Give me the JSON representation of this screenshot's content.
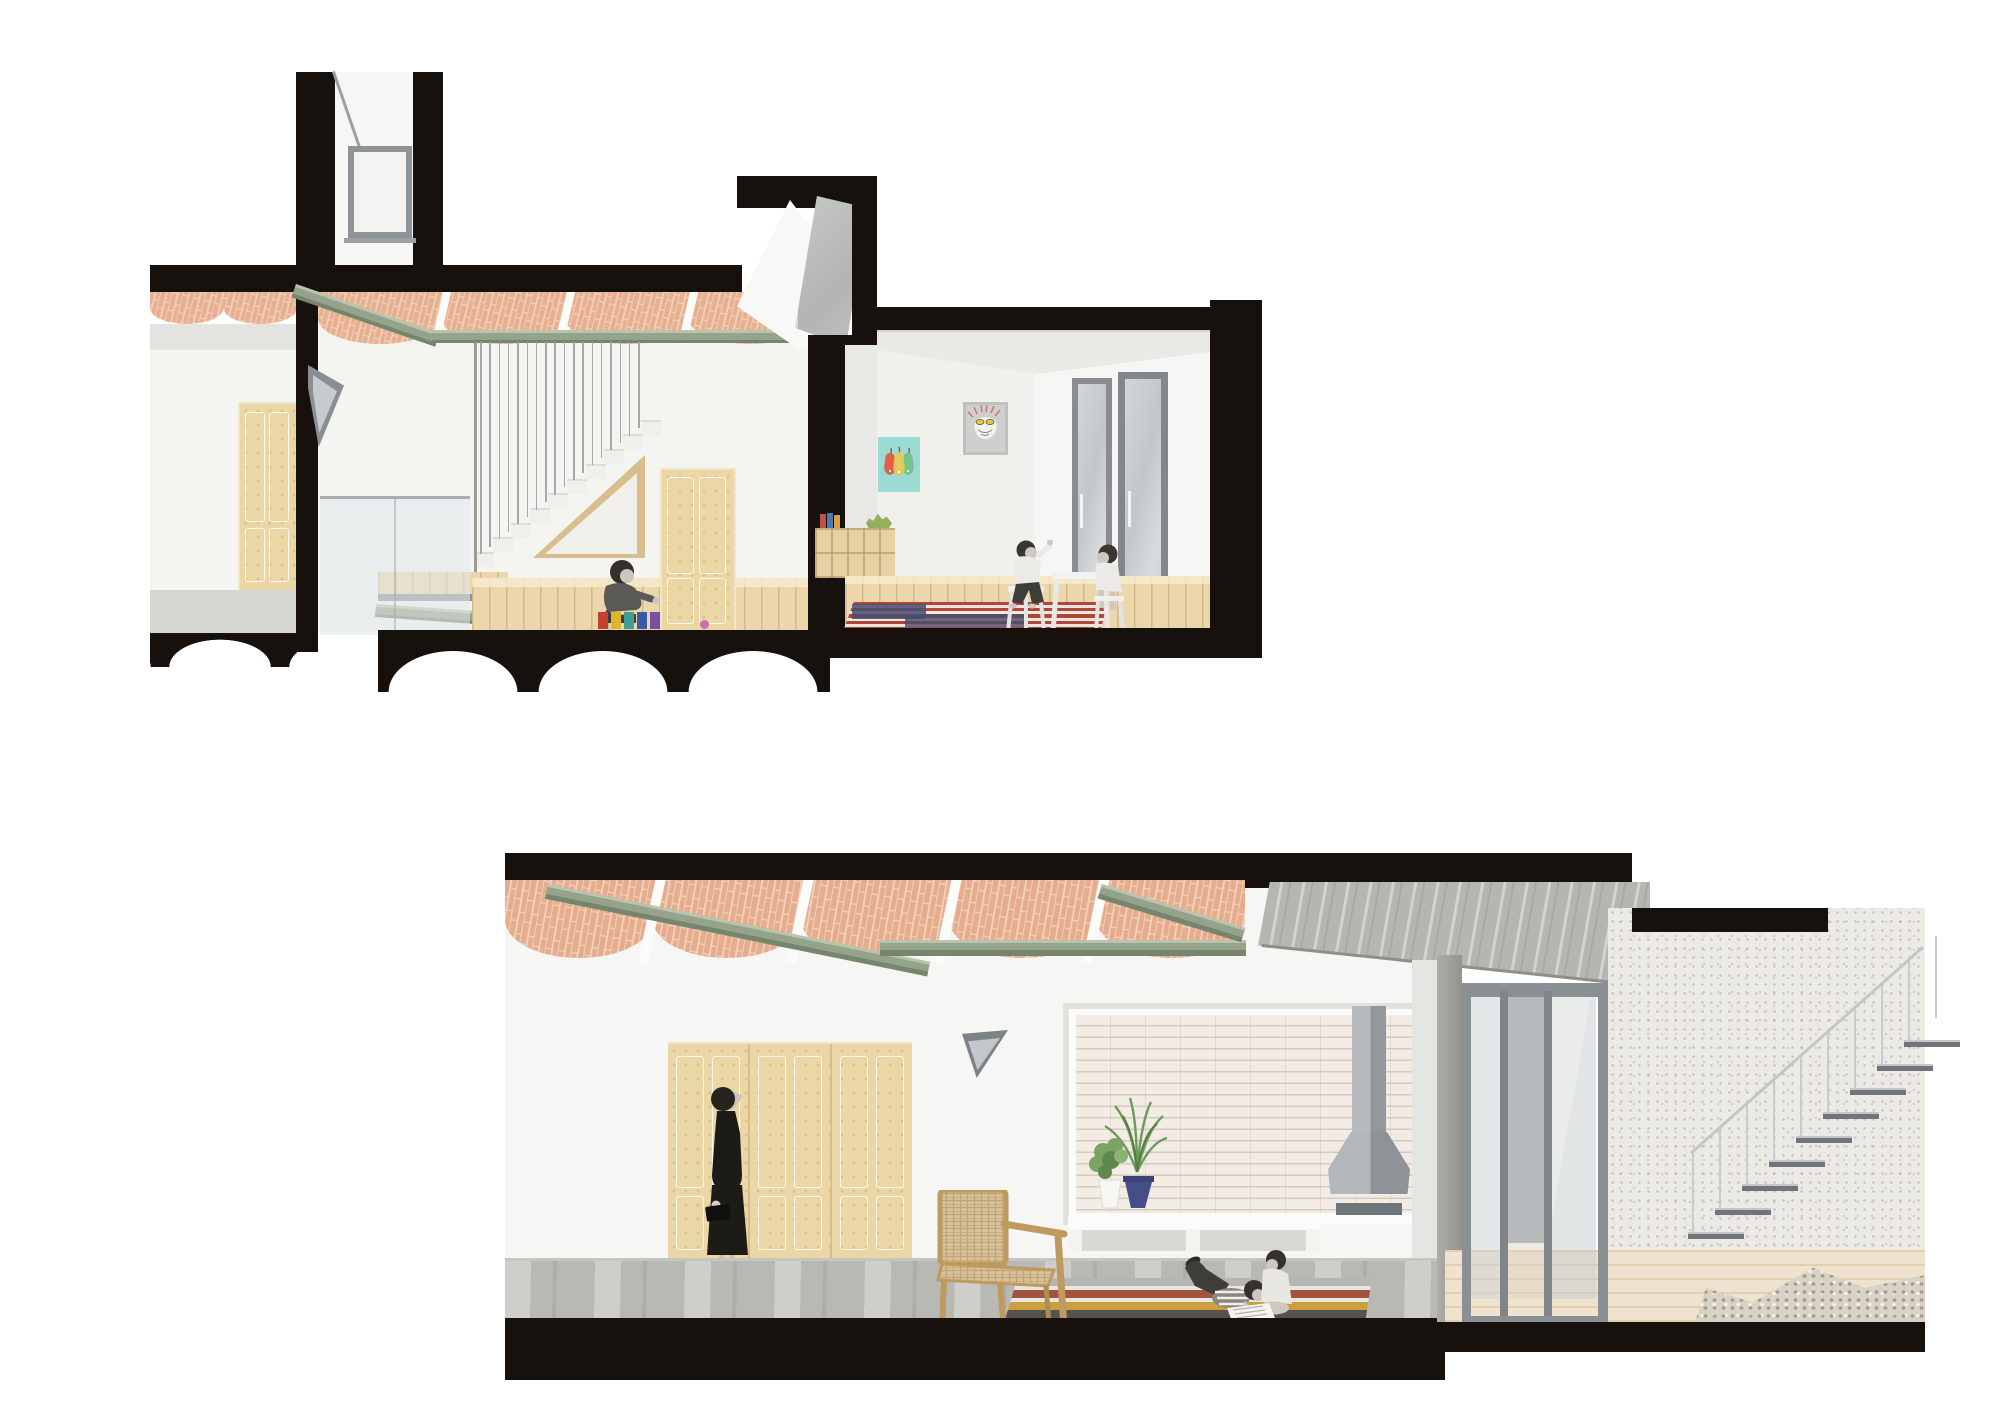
{
  "sheet": {
    "kind": "architectural-section-illustration",
    "drawings": 2,
    "background": "#ffffff"
  },
  "palette": {
    "cut": "#17110e",
    "wall": "#f5f5f2",
    "wall2": "#ebebe8",
    "wood": "#ecd7ac",
    "woodline": "#d9bd8e",
    "woodhi": "#f4e6c6",
    "beam": "#95a38b",
    "beamlt": "#b9c3ae",
    "beamdk": "#76856d",
    "frame": "#878c90",
    "glass": "#d2d6d7",
    "glassdk": "#aaaeb1",
    "concrete": "#b6b6b0",
    "court": "#eceae4",
    "gravel": "#d9d3c6",
    "deck": "#efe3cf",
    "hood": "#aeb2b6",
    "hooddk": "#8f9397",
    "brick": "#e7b191",
    "brick_joint": "#f3d3bf",
    "poster_teal": "#9bdbd3",
    "rug_rust": "#a2543f",
    "rug_ochre": "#c99f3f",
    "rug_navy": "#474c6e"
  },
  "upper_section": {
    "elements": [
      "skylight-tower",
      "catalan-vault-ceiling",
      "steel-beams",
      "stair-rod-balustrade",
      "under-stair-triangular-window",
      "glass-balustrade",
      "wooden-doors",
      "toddler-playing-blocks",
      "playroom",
      "pears-poster",
      "doodle-poster",
      "cubby-bookshelf",
      "kids-table",
      "striped-rug",
      "glass-doors",
      "section-cut-walls"
    ]
  },
  "lower_section": {
    "elements": [
      "catalan-vault-ceiling",
      "steel-beams",
      "wardrobe-doors",
      "woman-looking-up",
      "triangle-marker",
      "alcove-white-brick",
      "fireplace-hood",
      "potted-plants",
      "white-bench",
      "wicker-armchair",
      "children-reading-on-rug",
      "striped-kilim-rug",
      "concrete-floor",
      "sliding-glass-doors",
      "concrete-slab",
      "courtyard-wall",
      "floating-stairs",
      "gravel",
      "timber-deck"
    ]
  },
  "generators": {
    "hall_rods": {
      "count": 18,
      "x0": 480,
      "y0": 342,
      "dx": 9.3,
      "dy": 0,
      "w": 1.6,
      "h": 212,
      "dh": -7.4,
      "color": "#a3a8ab"
    },
    "hall_steps": {
      "count": 10,
      "x0": 474,
      "y0": 552,
      "dx": 18.6,
      "dy": -14.7,
      "w": 20,
      "h": 15,
      "dh": 0,
      "color": "linear-gradient(180deg,#dcdcd8 0 2px,#efefec 2px)"
    },
    "stair_treads": {
      "count": 9,
      "x0": 1688,
      "y0": 1232,
      "dx": 27,
      "dy": -24,
      "w": 56,
      "h": 7,
      "dh": 0,
      "color": "linear-gradient(180deg,#c4c7c9 0 2px,#717579 2px)"
    },
    "stair_posts": {
      "count": 10,
      "x0": 1692,
      "y0": 1152,
      "dx": 27,
      "dy": -24,
      "w": 2,
      "h": 82,
      "dh": 0,
      "color": "#c9ccce"
    },
    "toy_blocks": {
      "count": 5,
      "x0": 598,
      "y0": 612,
      "dx": 13,
      "dy": 0,
      "w": 10,
      "h": 17,
      "dh": 0,
      "colors": [
        "#c4432f",
        "#e0b52c",
        "#3f9e98",
        "#3a59a6",
        "#7a4ea0"
      ]
    }
  },
  "figures": [
    {
      "name": "toddler-playing-blocks",
      "style": "grayscale-photo-collage"
    },
    {
      "name": "boy-and-girl-at-table",
      "style": "grayscale-photo-collage"
    },
    {
      "name": "woman-looking-up",
      "style": "grayscale-photo-collage"
    },
    {
      "name": "two-children-reading-on-rug",
      "style": "grayscale-photo-collage"
    }
  ]
}
